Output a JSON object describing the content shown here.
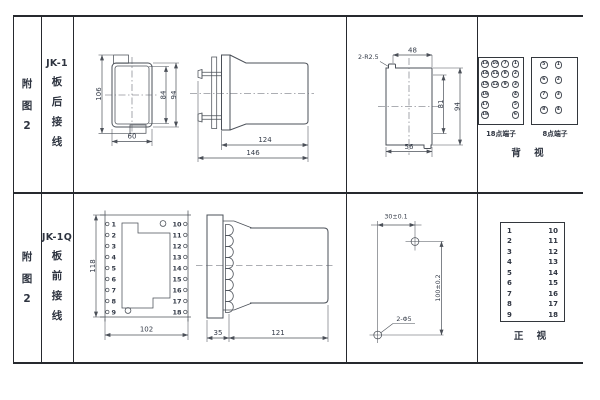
{
  "colors": {
    "bg": "#ffffff",
    "border": "#26292e",
    "line": "#4b5058",
    "text": "#333a47"
  },
  "row1": {
    "figure_label": [
      "附",
      "图",
      "2"
    ],
    "model": "JK-1",
    "wiring_label": [
      "板",
      "后",
      "接",
      "线"
    ],
    "back_view": {
      "dim_total_height": "106",
      "dim_inner_height": "84",
      "dim_outer_height": "94",
      "dim_width": "60"
    },
    "side_view": {
      "dim_body_length": "124",
      "dim_total_length": "146"
    },
    "cutout_view": {
      "dim_radius": "2-R2.5",
      "dim_top_width": "48",
      "dim_inner_height": "81",
      "dim_outer_height": "94",
      "dim_bottom_width": "56"
    },
    "rear_terminals": {
      "block18": {
        "label": "18点端子",
        "rows": [
          [
            "13",
            "10",
            "7",
            "1"
          ],
          [
            "14",
            "11",
            "8",
            "2"
          ],
          [
            "15",
            "12",
            "9",
            "3"
          ],
          [
            "16",
            "",
            "",
            "4"
          ],
          [
            "17",
            "",
            "",
            "5"
          ],
          [
            "18",
            "",
            "",
            "6"
          ]
        ]
      },
      "block8": {
        "label": "8点端子",
        "rows": [
          [
            "5",
            "1"
          ],
          [
            "6",
            "2"
          ],
          [
            "7",
            "3"
          ],
          [
            "8",
            "4"
          ]
        ]
      },
      "view_label": "背 视"
    }
  },
  "row2": {
    "figure_label": [
      "附",
      "图",
      "2"
    ],
    "model": "JK-1Q",
    "wiring_label": [
      "板",
      "前",
      "接",
      "线"
    ],
    "terminal_numbers": {
      "left": [
        "1",
        "2",
        "3",
        "4",
        "5",
        "6",
        "7",
        "8",
        "9"
      ],
      "right": [
        "10",
        "11",
        "12",
        "13",
        "14",
        "15",
        "16",
        "17",
        "18"
      ]
    },
    "front_view": {
      "dim_height": "118",
      "dim_width": "102"
    },
    "side_view": {
      "dim_flange": "35",
      "dim_body": "121"
    },
    "drill_view": {
      "dim_horizontal": "30±0.1",
      "dim_vertical": "100±0.2",
      "dim_holes": "2-Φ5"
    },
    "front_table_label": "正 视"
  }
}
